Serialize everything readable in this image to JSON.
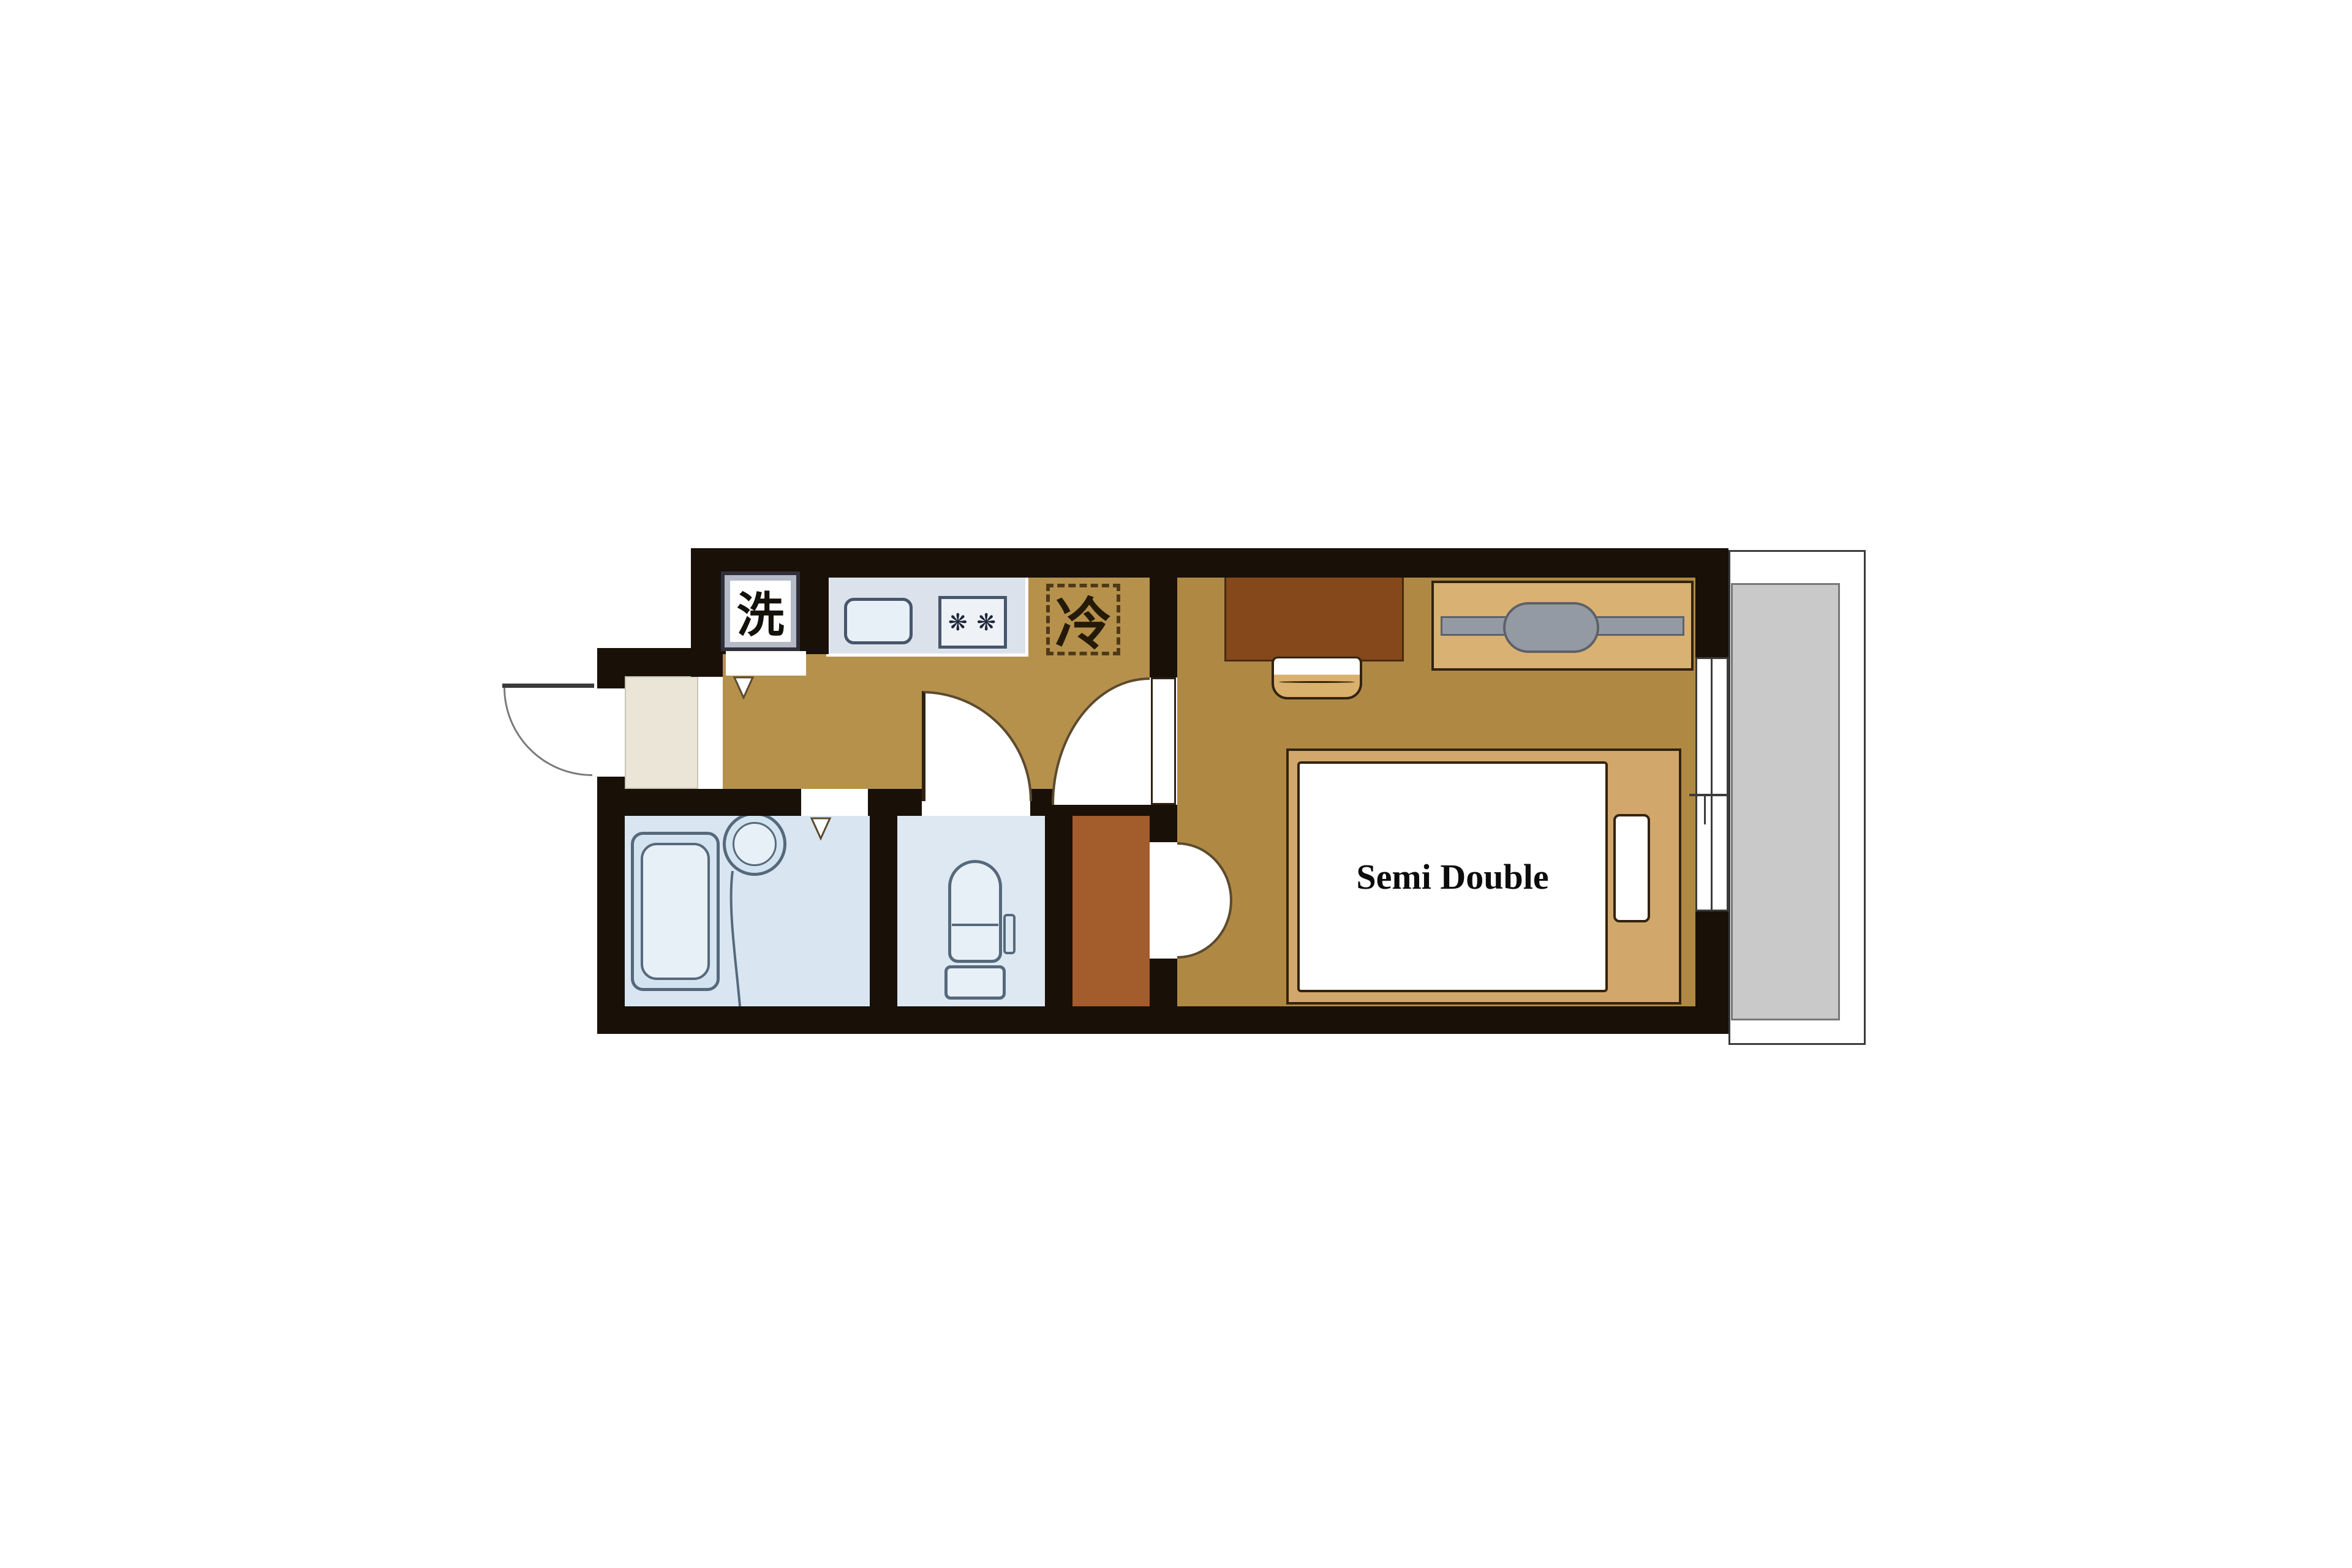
{
  "floorplan": {
    "bed_label": "Semi Double",
    "washer_label": "洗",
    "fridge_label": "冷",
    "icons": {
      "stove_burners": "❋ ❋",
      "door_direction_marker": "triangle-down"
    },
    "colors": {
      "wall": "#191008",
      "hall": "#b6914c",
      "bedroom": "#af8944",
      "bath": "#d9e6f2",
      "toiletRoom": "#dde8f3",
      "closet": "#a35c2b",
      "genkan": "#eae5d7",
      "counter": "#dbe2ec",
      "counterLine": "#46566c",
      "fixFill": "#e7eff7",
      "fixLine": "#56697b",
      "tubFill": "#d4e3f0",
      "balconyFloor": "#c9c9c9",
      "balconyLine": "#3a3a3a",
      "bedFrame": "#d2a76b",
      "rack": "#d8b173",
      "desk": "#84481a",
      "chair": "#d9b06c",
      "rod": "#949aa4",
      "rodLine": "#5d6168",
      "arc": "#5c4a2e",
      "leaf": "#2f2212",
      "boxBorder": "#30303c",
      "boxFill": "#b4bac6",
      "fridgeDash": "#4e3a18",
      "windowLine": "#3c3c3c",
      "outline": "#33230d",
      "white": "#ffffff"
    }
  }
}
